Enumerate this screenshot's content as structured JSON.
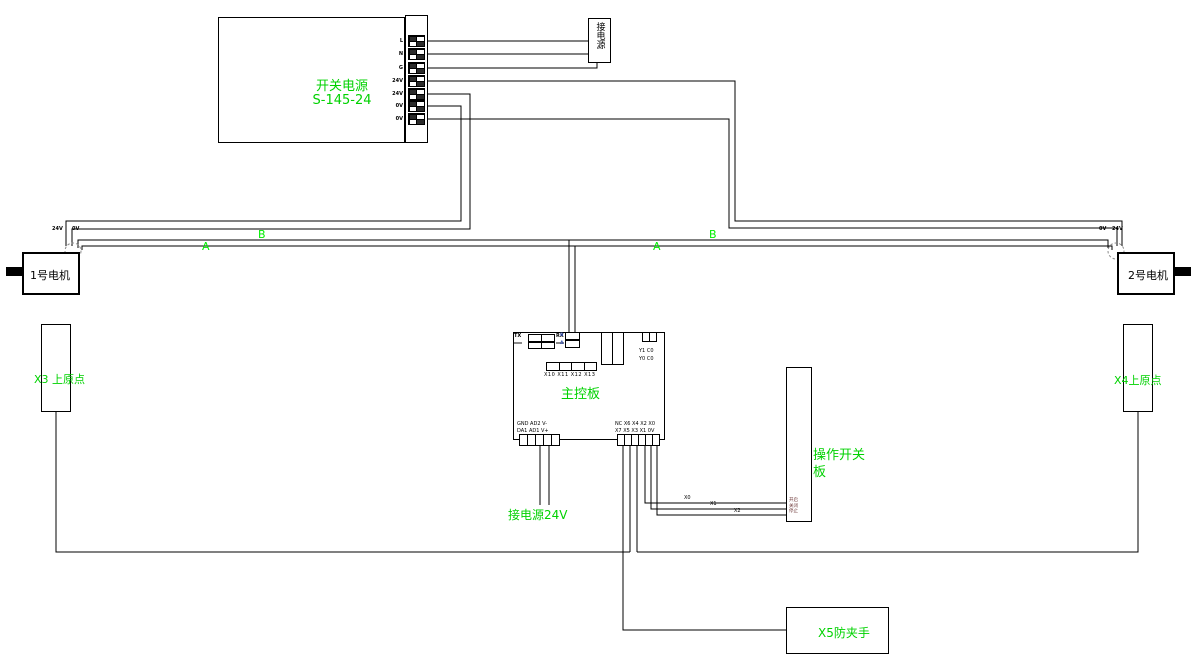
{
  "colors": {
    "wire": "#000000",
    "green_text": "#00d200",
    "bus_label_green": "#00ee00",
    "comm_label_blue": "#3a55b0"
  },
  "power_supply": {
    "title_line1": "开关电源",
    "title_line2": "S-145-24",
    "terminals": [
      "L",
      "N",
      "G",
      "24V",
      "24V",
      "0V",
      "0V"
    ]
  },
  "power_inlet": {
    "label": "接电源"
  },
  "motor_left": {
    "label": "1号电机",
    "wire_label_left": "24V",
    "wire_label_right": "0V"
  },
  "motor_right": {
    "label": "2号电机",
    "wire_label_left": "0V",
    "wire_label_right": "24V"
  },
  "bus": {
    "a": "A",
    "b": "B"
  },
  "sensors": {
    "left": "X3 上原点",
    "right": "X4上原点"
  },
  "main_board": {
    "title": "主控板",
    "tx": "TX",
    "rx": "RX",
    "comm_top": "B",
    "comm_bottom": "A",
    "output_row1": "Y1 C0",
    "output_row2": "Y0 C0",
    "io_strip_labels": "X10 X11 X12 X13",
    "analog_row1": "GND AD2 V-",
    "analog_row2": "DA1 AD1 V+",
    "input_row1": "NC X6 X4 X2 X0",
    "input_row2": "X7 X5 X3 X1 0V"
  },
  "power_label_24v": "接电源24V",
  "op_board": {
    "label_line1": "操作开关",
    "label_line2": "板",
    "buttons": [
      "开启",
      "关闭",
      "停止"
    ]
  },
  "anti_pinch": {
    "label": "X5防夹手"
  },
  "wire_tags": {
    "x0": "X0",
    "x1": "X1",
    "x2": "X2"
  }
}
